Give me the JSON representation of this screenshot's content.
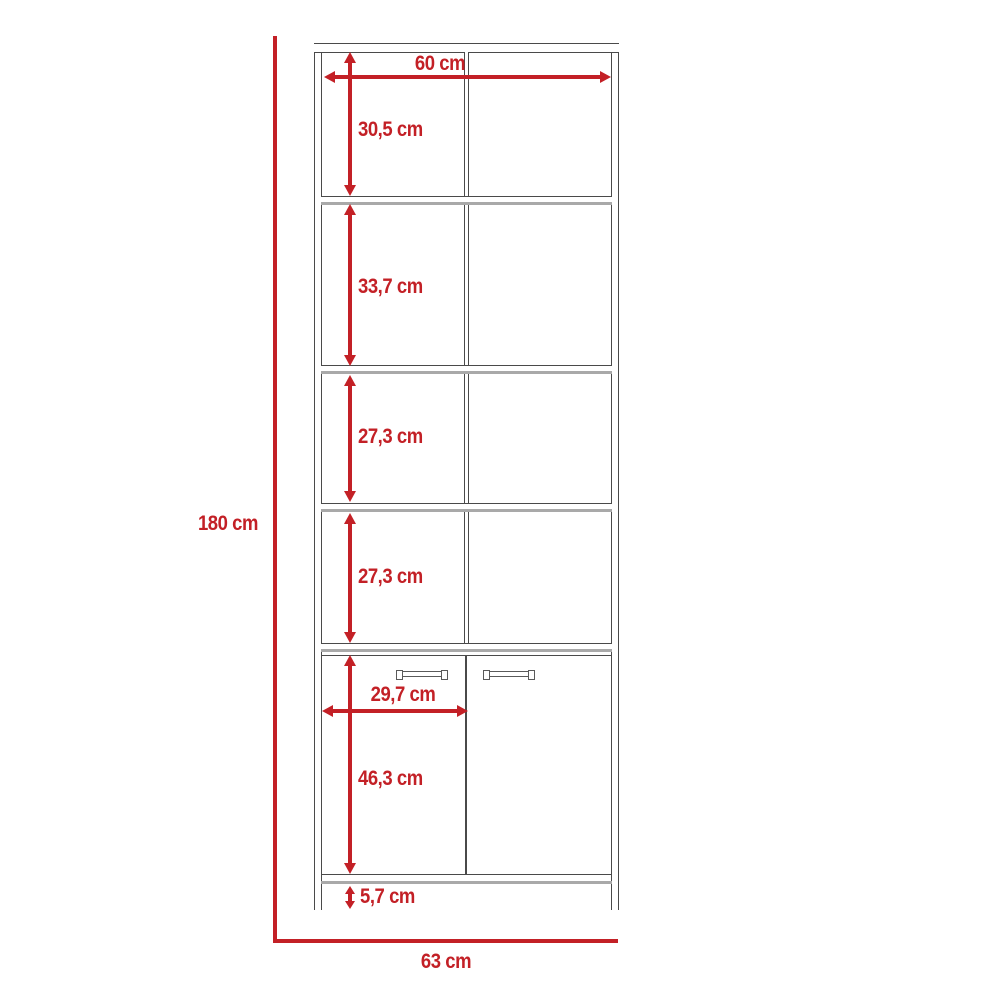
{
  "diagram": {
    "type": "furniture-dimension-diagram",
    "subject": "tall shelving unit with four open shelves and two-door lower cabinet",
    "units": "cm",
    "colors": {
      "dimension_red": "#c32026",
      "outline_dark": "#4a4a4a",
      "shelf_shadow_gray": "#a9a9a9",
      "background": "#ffffff"
    },
    "overall": {
      "total_height": "180 cm",
      "base_width": "63 cm"
    },
    "dimensions": [
      {
        "id": "interior-width",
        "label": "60 cm",
        "orientation": "horizontal"
      },
      {
        "id": "shelf-1-height",
        "label": "30,5 cm",
        "orientation": "vertical"
      },
      {
        "id": "shelf-2-height",
        "label": "33,7 cm",
        "orientation": "vertical"
      },
      {
        "id": "shelf-3-height",
        "label": "27,3 cm",
        "orientation": "vertical"
      },
      {
        "id": "shelf-4-height",
        "label": "27,3 cm",
        "orientation": "vertical"
      },
      {
        "id": "door-width",
        "label": "29,7 cm",
        "orientation": "horizontal"
      },
      {
        "id": "door-height",
        "label": "46,3 cm",
        "orientation": "vertical"
      },
      {
        "id": "leg-height",
        "label": "5,7 cm",
        "orientation": "vertical"
      }
    ]
  }
}
